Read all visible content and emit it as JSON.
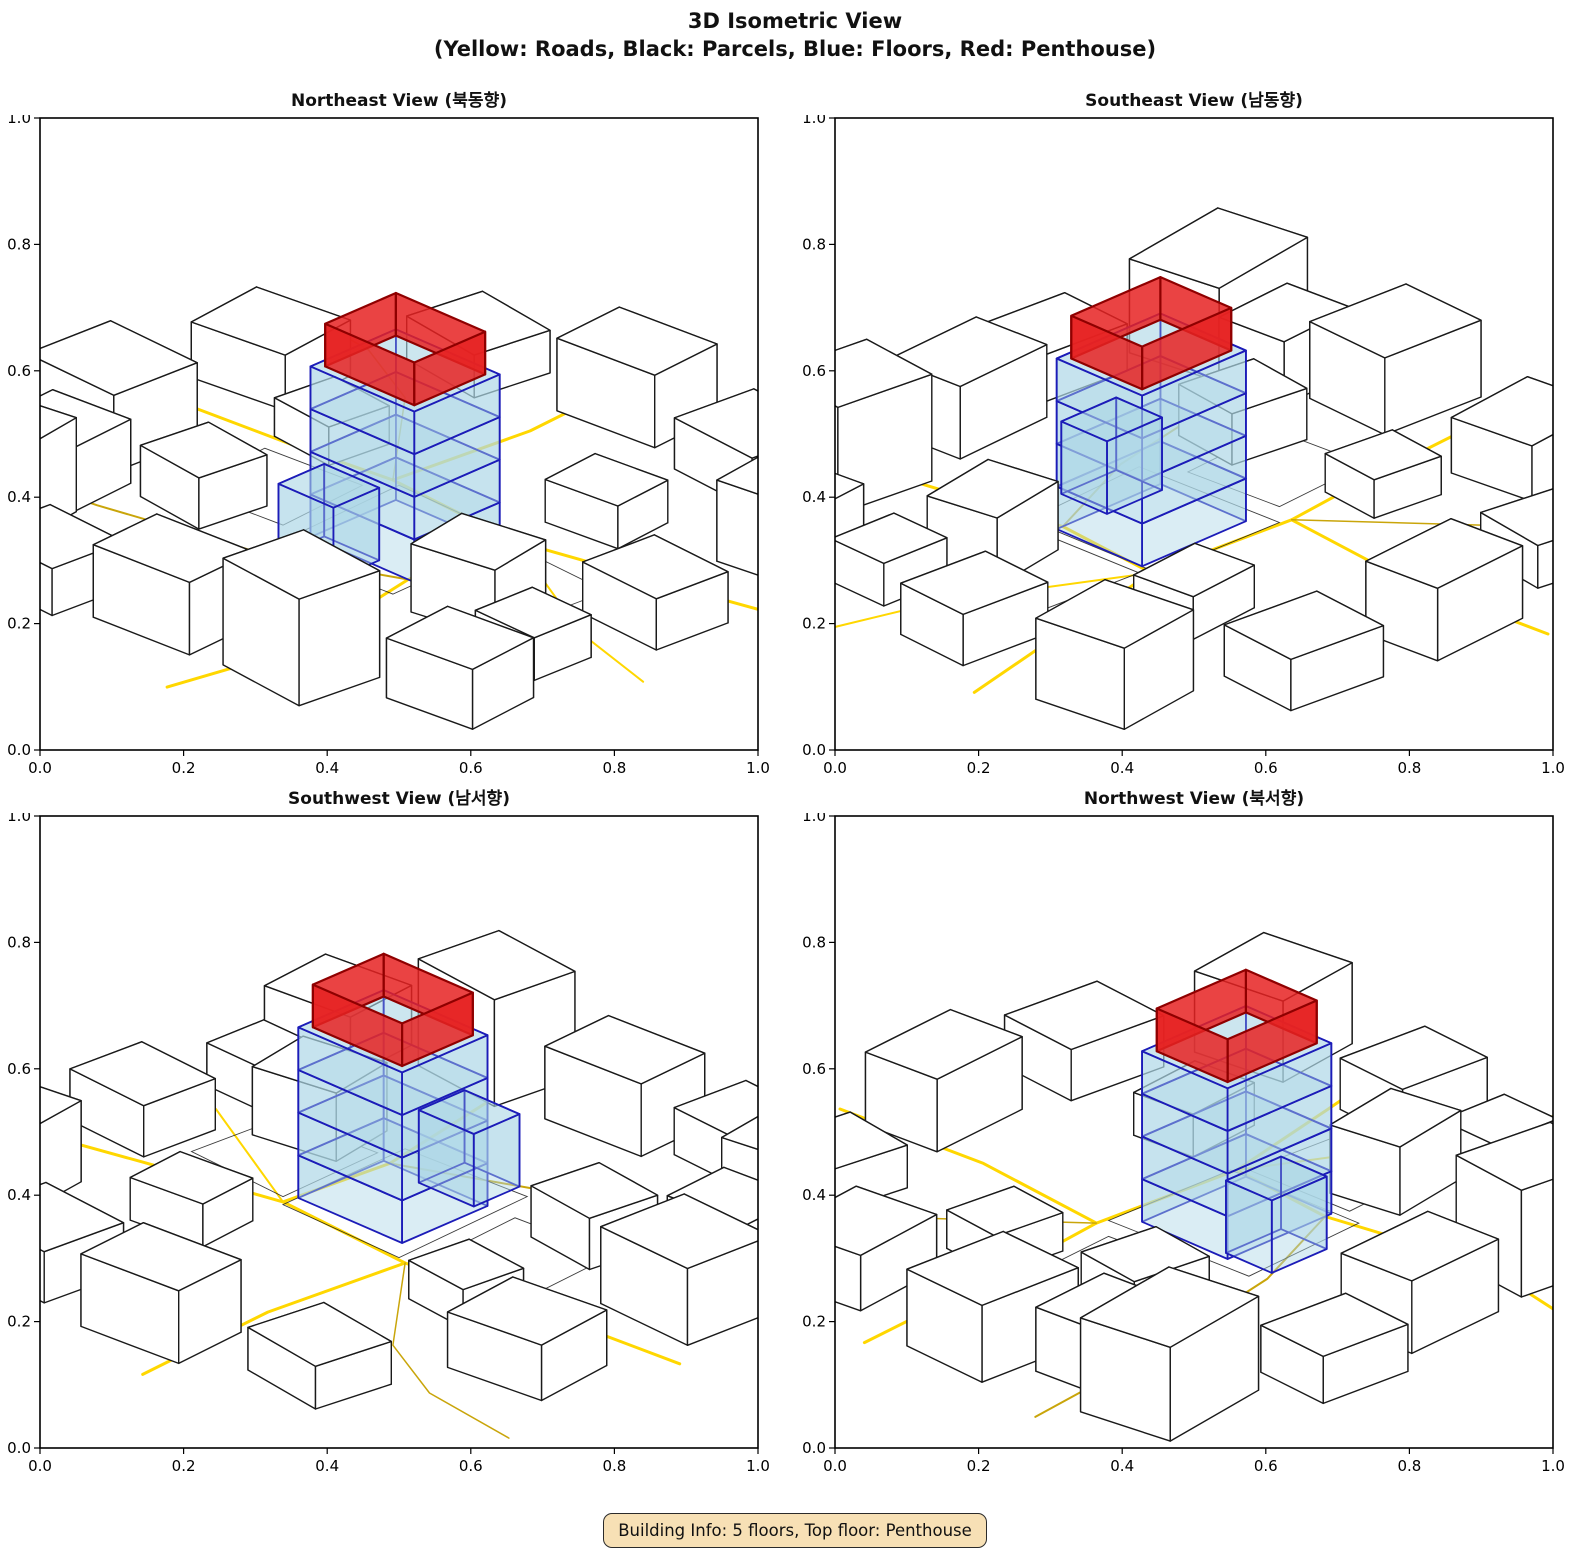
{
  "title": "3D Isometric View",
  "subtitle": "(Yellow: Roads, Black: Parcels, Blue: Floors, Red: Penthouse)",
  "footer": {
    "building_info": "Building Info: 5 floors, Top floor: Penthouse"
  },
  "colors": {
    "background": "#ffffff",
    "road": "#FFD700",
    "road_dark": "#C9A50A",
    "parcel_edge": "#1a1a1a",
    "building_fill": "#ffffff",
    "floor_fill": "#ADD8E6",
    "floor_edge": "#1C1CB8",
    "penthouse_fill": "#E62222",
    "penthouse_edge": "#8F0000",
    "info_bg": "#F7E0B5",
    "info_border": "#2b2b2b"
  },
  "chart_data": {
    "type": "3d-isometric-multiview",
    "title": "3D Isometric View",
    "legend_note": "(Yellow: Roads, Black: Parcels, Blue: Floors, Red: Penthouse)",
    "views": [
      {
        "title": "Northeast View (북동향)",
        "azimuth": 0
      },
      {
        "title": "Southeast View (남동향)",
        "azimuth": 90
      },
      {
        "title": "Southwest View (남서향)",
        "azimuth": 180
      },
      {
        "title": "Northwest View (북서향)",
        "azimuth": 270
      }
    ],
    "axis": {
      "range": [
        0,
        1
      ],
      "ticks": [
        0,
        0.2,
        0.4,
        0.6,
        0.8,
        1.0
      ]
    },
    "building": {
      "floors": 5,
      "top_floor": "Penthouse",
      "floor_height": 0.05,
      "footprint": [
        0.54,
        0.53,
        0.17,
        0.14
      ],
      "penthouse_inset": 0.012,
      "annex": [
        0.51,
        0.625,
        0.09,
        0.075,
        0.085
      ]
    },
    "parcels_3d": [
      [
        0.14,
        0.82,
        0.17,
        0.13,
        0.11,
        -8
      ],
      [
        0.33,
        0.9,
        0.13,
        0.11,
        0.055,
        4
      ],
      [
        0.5,
        0.87,
        0.15,
        0.11,
        0.085,
        -3
      ],
      [
        0.7,
        0.86,
        0.14,
        0.12,
        0.125,
        6
      ],
      [
        0.88,
        0.78,
        0.13,
        0.11,
        0.07,
        -5
      ],
      [
        0.1,
        0.57,
        0.15,
        0.13,
        0.09,
        3
      ],
      [
        0.12,
        0.33,
        0.14,
        0.12,
        0.065,
        -6
      ],
      [
        0.27,
        0.14,
        0.13,
        0.11,
        0.05,
        8
      ],
      [
        0.49,
        0.1,
        0.15,
        0.11,
        0.085,
        -4
      ],
      [
        0.7,
        0.12,
        0.14,
        0.12,
        0.06,
        5
      ],
      [
        0.89,
        0.24,
        0.13,
        0.13,
        0.095,
        -7
      ],
      [
        0.89,
        0.47,
        0.13,
        0.11,
        0.06,
        4
      ],
      [
        0.73,
        0.6,
        0.12,
        0.1,
        0.08,
        -9
      ],
      [
        0.3,
        0.62,
        0.11,
        0.1,
        0.06,
        7
      ],
      [
        0.67,
        0.33,
        0.11,
        0.09,
        0.05,
        -5
      ],
      [
        0.29,
        0.4,
        0.1,
        0.09,
        0.045,
        6
      ],
      [
        0.86,
        0.64,
        0.1,
        0.09,
        0.05,
        2
      ],
      [
        0.15,
        0.7,
        0.12,
        0.1,
        0.075,
        -4
      ]
    ],
    "roads": [
      {
        "pts": [
          [
            0.0,
            0.46
          ],
          [
            0.28,
            0.44
          ],
          [
            0.415,
            0.425
          ],
          [
            0.435,
            0.22
          ],
          [
            0.42,
            0.0
          ]
        ],
        "w": 3,
        "tone": "gold"
      },
      {
        "pts": [
          [
            0.415,
            0.425
          ],
          [
            0.63,
            0.44
          ],
          [
            0.82,
            0.4
          ],
          [
            1.0,
            0.36
          ]
        ],
        "w": 3,
        "tone": "gold"
      },
      {
        "pts": [
          [
            0.63,
            0.44
          ],
          [
            0.615,
            0.6
          ],
          [
            0.655,
            0.82
          ],
          [
            0.62,
            1.0
          ]
        ],
        "w": 3,
        "tone": "gold"
      },
      {
        "pts": [
          [
            0.0,
            0.74
          ],
          [
            0.22,
            0.715
          ],
          [
            0.45,
            0.67
          ],
          [
            0.615,
            0.6
          ]
        ],
        "w": 2,
        "tone": "dark"
      },
      {
        "pts": [
          [
            0.63,
            0.44
          ],
          [
            0.86,
            0.56
          ],
          [
            1.0,
            0.6
          ]
        ],
        "w": 2,
        "tone": "gold"
      },
      {
        "pts": [
          [
            0.0,
            0.18
          ],
          [
            0.15,
            0.2
          ],
          [
            0.27,
            0.26
          ],
          [
            0.415,
            0.425
          ]
        ],
        "w": 1.5,
        "tone": "dark"
      }
    ],
    "ground_parcels": [
      [
        [
          0.43,
          0.43
        ],
        [
          0.625,
          0.435
        ],
        [
          0.63,
          0.64
        ],
        [
          0.44,
          0.65
        ]
      ],
      [
        [
          0.64,
          0.45
        ],
        [
          0.8,
          0.46
        ],
        [
          0.79,
          0.6
        ],
        [
          0.645,
          0.61
        ]
      ],
      [
        [
          0.25,
          0.47
        ],
        [
          0.4,
          0.46
        ],
        [
          0.41,
          0.6
        ],
        [
          0.26,
          0.61
        ]
      ]
    ]
  }
}
